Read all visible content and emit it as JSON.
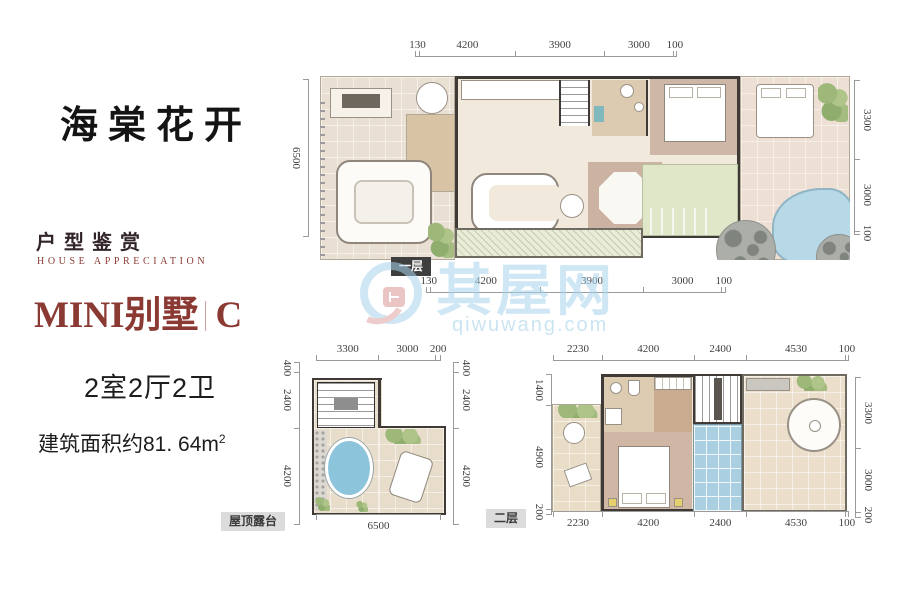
{
  "page": {
    "background": "#ffffff"
  },
  "left_panel": {
    "project_title": "海棠花开",
    "section_title_cn": "户型鉴赏",
    "section_title_en": "HOUSE APPRECIATION",
    "unit_name": "MINI别墅",
    "unit_variant": "C",
    "rooms_summary": "2室2厅2卫",
    "area_label": "建筑面积约81. 64m",
    "area_superscript": "2",
    "accent_color": "#8b3a33"
  },
  "floor_first": {
    "label": "一层",
    "dims_top": [
      "130",
      "4200",
      "3900",
      "3000",
      "100"
    ],
    "dims_bottom": [
      "130",
      "4200",
      "3900",
      "3000",
      "100"
    ],
    "dims_left": [
      "6500"
    ],
    "dims_right": [
      "3300",
      "3000",
      "100"
    ]
  },
  "roof_terrace": {
    "label": "屋顶露台",
    "dims_top": [
      "3300",
      "3000",
      "200"
    ],
    "dims_left": [
      "400",
      "2400",
      "4200"
    ],
    "dims_right": [
      "400",
      "2400",
      "4200"
    ],
    "dims_bottom": [
      "6500"
    ]
  },
  "floor_second": {
    "label": "二层",
    "dims_top": [
      "2230",
      "4200",
      "2400",
      "4530",
      "100"
    ],
    "dims_bottom": [
      "2230",
      "4200",
      "2400",
      "4530",
      "100"
    ],
    "dims_left": [
      "1400",
      "4900",
      "200"
    ],
    "dims_right": [
      "3300",
      "3000",
      "200"
    ]
  },
  "brand_watermark": {
    "name": "其屋网",
    "domain": "qiwuwang.com",
    "color": "#a9d4ee"
  },
  "palette": {
    "wall": "#3f3a36",
    "floor_beige": "#eadfd3",
    "floor_wood": "#cfb7a8",
    "lawn_green": "#dfe7c8",
    "pool_blue": "#b7d8e6",
    "skylight_blue": "#aacfe1"
  }
}
